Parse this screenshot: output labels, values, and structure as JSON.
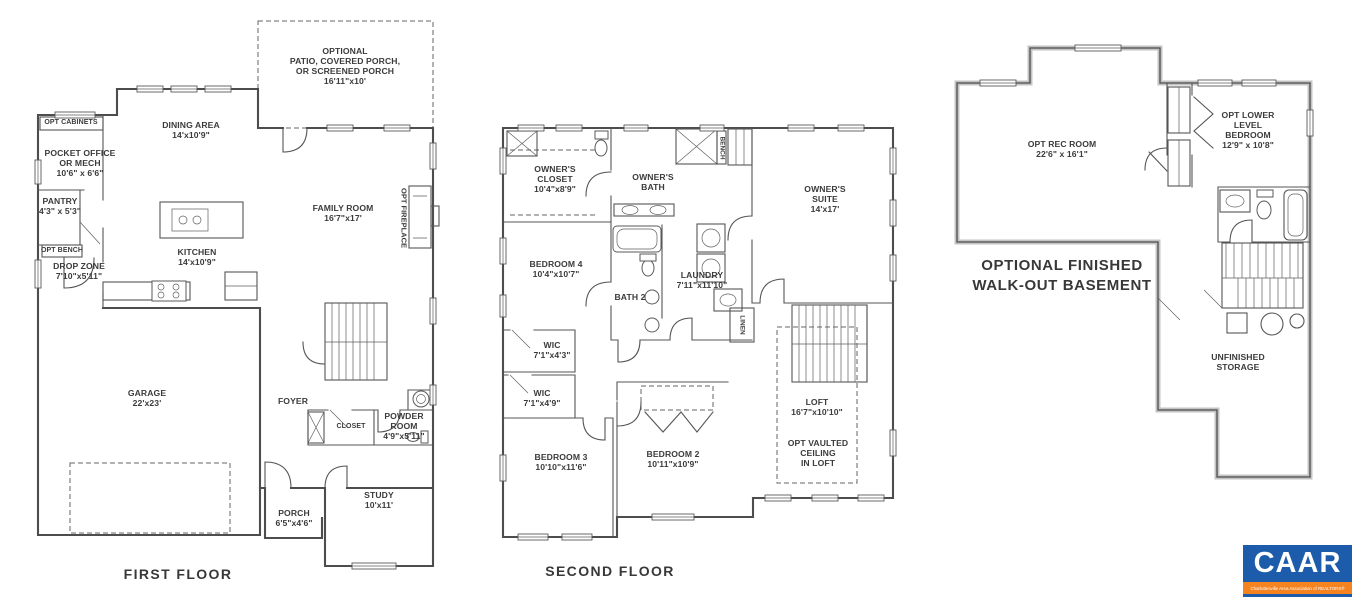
{
  "floors": {
    "first": {
      "title": "FIRST FLOOR",
      "rooms": {
        "patio": {
          "l1": "OPTIONAL",
          "l2": "PATIO, COVERED PORCH,",
          "l3": "OR SCREENED PORCH",
          "dim": "16'11\"x10'"
        },
        "dining": {
          "name": "DINING AREA",
          "dim": "14'x10'9\""
        },
        "cabinets": {
          "name": "OPT CABINETS"
        },
        "office": {
          "l1": "POCKET OFFICE",
          "l2": "OR MECH",
          "dim": "10'6\" x 6'6\""
        },
        "pantry": {
          "name": "PANTRY",
          "dim": "4'3\" x 5'3\""
        },
        "bench": {
          "name": "OPT BENCH"
        },
        "dropzone": {
          "name": "DROP ZONE",
          "dim": "7'10\"x5'11\""
        },
        "kitchen": {
          "name": "KITCHEN",
          "dim": "14'x10'9\""
        },
        "family": {
          "name": "FAMILY ROOM",
          "dim": "16'7\"x17'"
        },
        "fireplace": {
          "name": "OPT FIREPLACE"
        },
        "garage": {
          "name": "GARAGE",
          "dim": "22'x23'"
        },
        "foyer": {
          "name": "FOYER"
        },
        "closet": {
          "name": "CLOSET"
        },
        "powder": {
          "l1": "POWDER",
          "l2": "ROOM",
          "dim": "4'9\"x5'11\""
        },
        "porch": {
          "name": "PORCH",
          "dim": "6'5\"x4'6\""
        },
        "study": {
          "name": "STUDY",
          "dim": "10'x11'"
        }
      }
    },
    "second": {
      "title": "SECOND FLOOR",
      "rooms": {
        "oclo": {
          "l1": "OWNER'S",
          "l2": "CLOSET",
          "dim": "10'4\"x8'9\""
        },
        "obath": {
          "l1": "OWNER'S",
          "l2": "BATH"
        },
        "bench": {
          "name": "BENCH"
        },
        "suite": {
          "l1": "OWNER'S",
          "l2": "SUITE",
          "dim": "14'x17'"
        },
        "bed4": {
          "name": "BEDROOM 4",
          "dim": "10'4\"x10'7\""
        },
        "bath2": {
          "name": "BATH 2"
        },
        "laundry": {
          "name": "LAUNDRY",
          "dim": "7'11\"x11'10\""
        },
        "linen": {
          "name": "LINEN"
        },
        "wica": {
          "name": "WIC",
          "dim": "7'1\"x4'3\""
        },
        "wicb": {
          "name": "WIC",
          "dim": "7'1\"x4'9\""
        },
        "bed3": {
          "name": "BEDROOM 3",
          "dim": "10'10\"x11'6\""
        },
        "bed2": {
          "name": "BEDROOM 2",
          "dim": "10'11\"x10'9\""
        },
        "loft": {
          "name": "LOFT",
          "dim": "16'7\"x10'10\""
        },
        "vaulted": {
          "l1": "OPT VAULTED",
          "l2": "CEILING",
          "l3": "IN LOFT"
        }
      }
    },
    "basement": {
      "title_l1": "OPTIONAL FINISHED",
      "title_l2": "WALK-OUT BASEMENT",
      "rooms": {
        "rec": {
          "name": "OPT REC ROOM",
          "dim": "22'6\" x 16'1\""
        },
        "lbed": {
          "l1": "OPT LOWER",
          "l2": "LEVEL",
          "l3": "BEDROOM",
          "dim": "12'9\" x 10'8\""
        },
        "storage": {
          "l1": "UNFINISHED",
          "l2": "STORAGE"
        }
      }
    }
  },
  "logo": {
    "name": "CAAR",
    "tagline": "Charlottesville Area Association of REALTORS®",
    "bg_color": "#1d5caa",
    "bar_color": "#f5831f"
  }
}
